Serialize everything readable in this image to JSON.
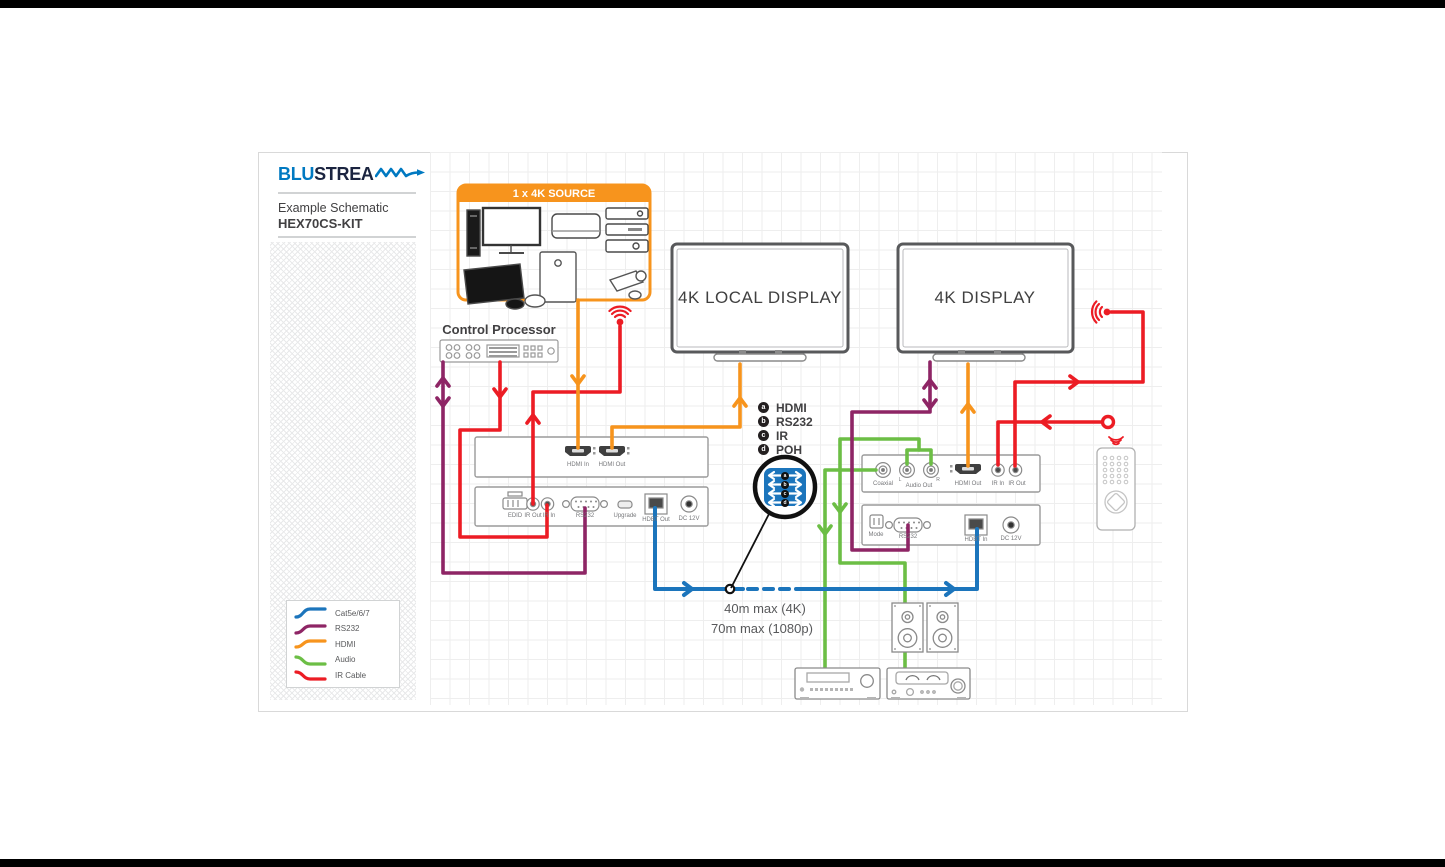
{
  "brand": {
    "blu": "BLU",
    "stream": "STREA"
  },
  "titles": {
    "subtitle": "Example Schematic",
    "model": "HEX70CS-KIT"
  },
  "source_box": {
    "title": "1 x 4K SOURCE"
  },
  "devices": {
    "control_processor": "Control Processor",
    "local_display": "4K LOCAL DISPLAY",
    "display": "4K DISPLAY"
  },
  "signal_legend": {
    "items": [
      {
        "key": "a",
        "label": "HDMI"
      },
      {
        "key": "b",
        "label": "RS232"
      },
      {
        "key": "c",
        "label": "IR"
      },
      {
        "key": "d",
        "label": "POH"
      }
    ]
  },
  "cable_legend": {
    "items": [
      {
        "label": "Cat5e/6/7",
        "color": "#1C75BC"
      },
      {
        "label": "RS232",
        "color": "#8E2565"
      },
      {
        "label": "HDMI",
        "color": "#F7941D"
      },
      {
        "label": "Audio",
        "color": "#6CBE45"
      },
      {
        "label": "IR Cable",
        "color": "#EC1C24"
      }
    ]
  },
  "link_note": {
    "line1": "40m max (4K)",
    "line2": "70m max (1080p)"
  },
  "tx": {
    "ports": {
      "hdmi_in": "HDMI In",
      "hdmi_out": "HDMI Out",
      "edid": "EDID",
      "ir_out": "IR Out",
      "ir_in": "IR In",
      "rs232": "RS232",
      "upgrade": "Upgrade",
      "hdbt_out": "HDBT Out",
      "dc": "DC 12V"
    }
  },
  "rx": {
    "ports": {
      "coaxial": "Coaxial",
      "audio_out": "Audio Out",
      "audio_l": "L",
      "audio_r": "R",
      "hdmi_out": "HDMI Out",
      "ir_in": "IR In",
      "ir_out": "IR Out",
      "mode": "Mode",
      "rs232": "RS232",
      "hdbt_in": "HDBT In",
      "dc": "DC 12V"
    }
  },
  "colors": {
    "orange": "#F7941D",
    "red": "#EC1C24",
    "purple": "#8E2565",
    "blue": "#1C75BC",
    "green": "#6CBE45",
    "brand_blue": "#0079C1",
    "brand_dark": "#1B2440"
  }
}
